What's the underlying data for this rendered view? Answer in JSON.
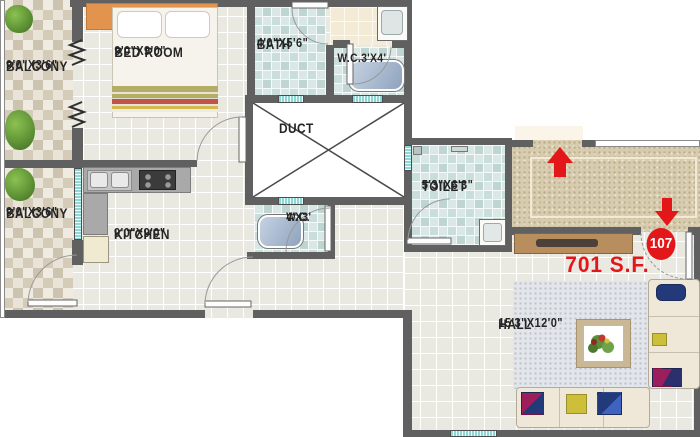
{
  "unit": {
    "number": "107",
    "area_label": "701 S.F."
  },
  "rooms": {
    "balcony_top": {
      "name": "BALCONY",
      "dims": "9'0\"X3'6\""
    },
    "bedroom": {
      "name": "BED ROOM",
      "dims": "9'0\"X9'0\""
    },
    "bath": {
      "name": "BATH",
      "dims": "4'0\"X5'6\""
    },
    "wc_top": {
      "label": "W.C.3'X4'"
    },
    "duct": {
      "name": "DUCT"
    },
    "balcony_bottom": {
      "name": "BALCONY",
      "dims": "9'0\"X3'6\""
    },
    "kitchen": {
      "name": "KITCHEN",
      "dims": "9'0\"X9'0\""
    },
    "wc_mid": {
      "name": "W.C.",
      "dims": "4'X3'"
    },
    "toilet": {
      "name": "TOILET",
      "dims": "5'3\"X6'3\""
    },
    "hall": {
      "name": "HALL",
      "dims": "15'3\"X12'0\""
    }
  },
  "colors": {
    "accent_red": "#e3161a",
    "wall_gray": "#606060",
    "window_teal": "#8fd6d4",
    "corridor_beige": "#d8ccae",
    "wet_room_tile": "#d9e8e5",
    "floor_tile": "#e9e8e1",
    "balcony_tile": "#d5cbb9",
    "cabinet_wood": "#b98e5f",
    "sofa_cream": "#efe8d8",
    "headboard_orange": "#e2944e"
  },
  "icons": {
    "entry_up_arrow": "up-arrow",
    "entry_down_arrow": "down-arrow"
  }
}
